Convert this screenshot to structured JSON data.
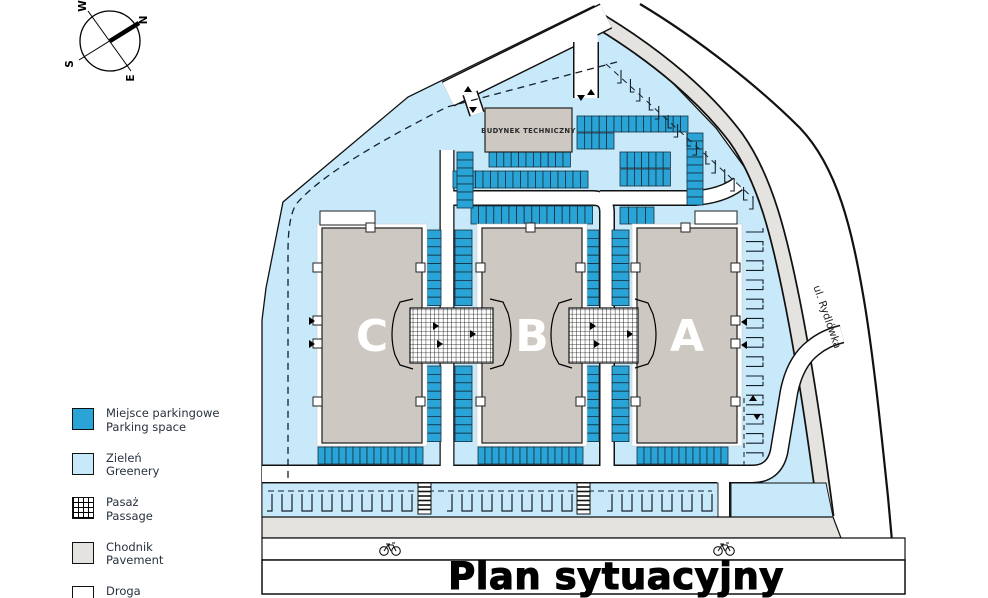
{
  "title": "Plan sytuacyjny",
  "compass": {
    "n": "N",
    "e": "E",
    "s": "S",
    "w": "W"
  },
  "legend": {
    "items": [
      {
        "label_pl": "Miejsce parkingowe",
        "label_en": "Parking space",
        "swatch": "parking"
      },
      {
        "label_pl": "Zieleń",
        "label_en": "Greenery",
        "swatch": "greenery"
      },
      {
        "label_pl": "Pasaż",
        "label_en": "Passage",
        "swatch": "passage"
      },
      {
        "label_pl": "Chodnik",
        "label_en": "Pavement",
        "swatch": "pavement"
      },
      {
        "label_pl": "Droga",
        "label_en": "Street",
        "swatch": "street"
      }
    ]
  },
  "map": {
    "technical_building_label": "BUDYNEK TECHNICZNY",
    "street_label": "ul. Rydlówka",
    "buildings": [
      {
        "label": "C"
      },
      {
        "label": "B"
      },
      {
        "label": "A"
      }
    ]
  },
  "colors": {
    "parking": "#2AA4D6",
    "greenery": "#C7E9F9",
    "pavement": "#E4E3E0",
    "street": "#FFFFFF",
    "building": "#CDC8C1",
    "outline": "#111111"
  }
}
